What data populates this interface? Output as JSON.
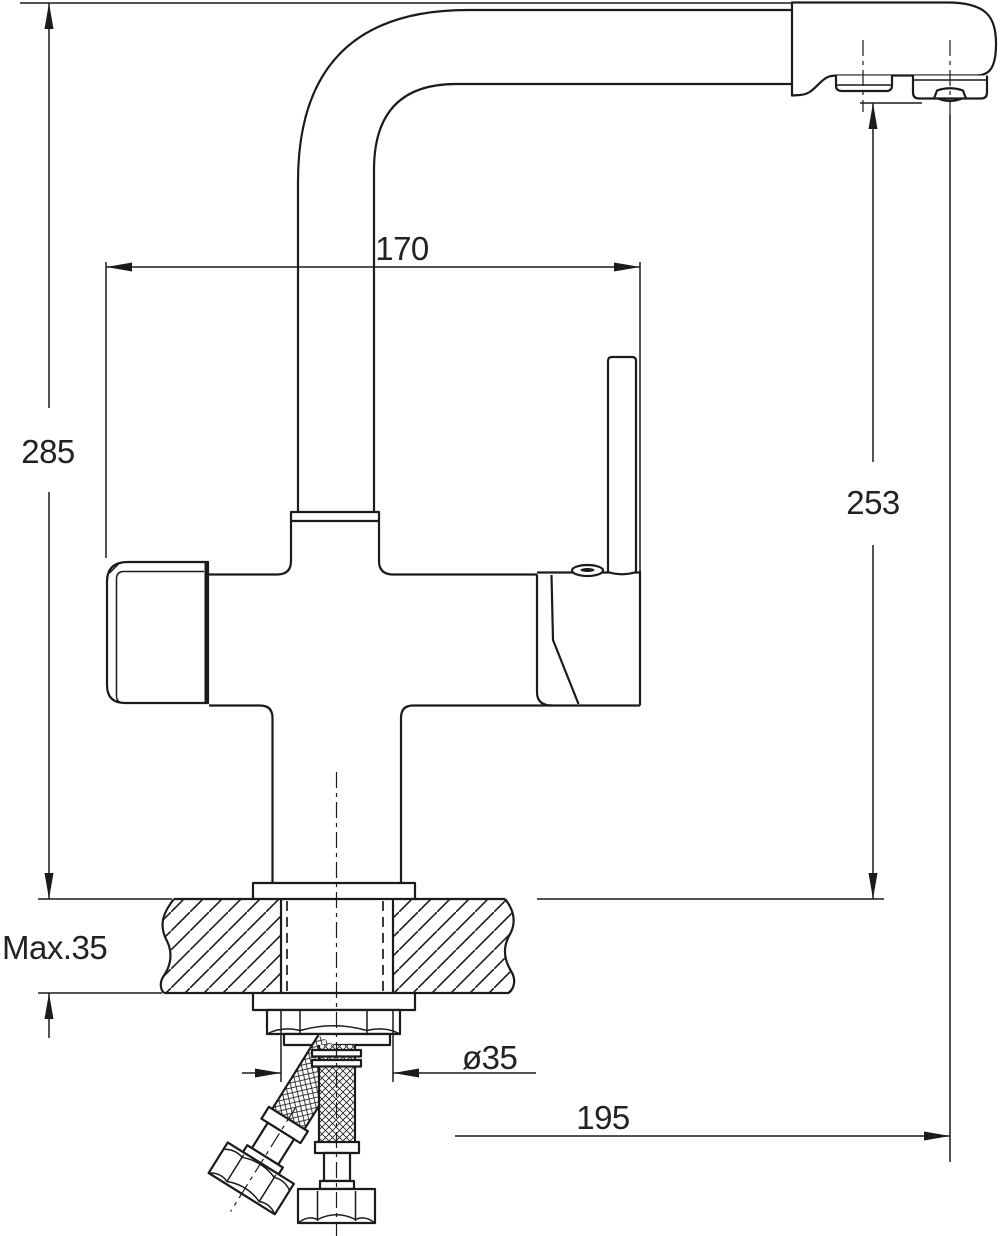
{
  "drawing": {
    "background": "#ffffff",
    "line_color": "#1b1b1b",
    "labels": {
      "spout_reach": "170",
      "overall_height": "285",
      "spout_height": "253",
      "max_counter_thickness": "Max.35",
      "hole_diameter": "ø35",
      "outlet_offset": "195"
    }
  }
}
